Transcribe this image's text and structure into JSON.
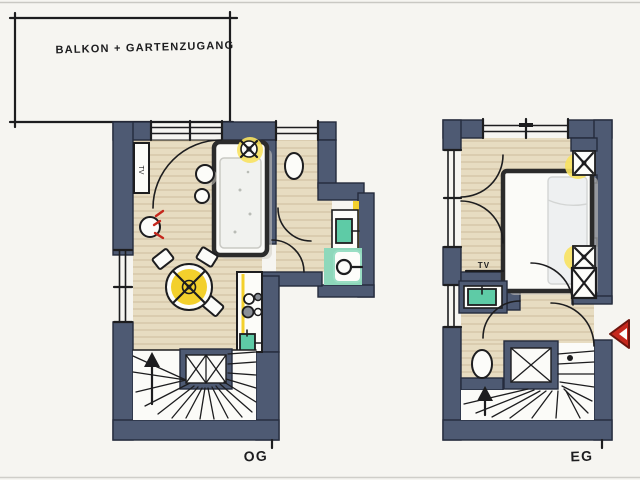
{
  "drawing": {
    "annotation_box": {
      "label": "BALKON + GARTENZUGANG"
    },
    "plans": [
      {
        "id": "og",
        "label": "OG",
        "tv_label": "TV"
      },
      {
        "id": "eg",
        "label": "EG",
        "tv_label": "TV"
      }
    ],
    "symbols": {
      "ceiling_lamp": "x-cross-lamp-icon",
      "pendant_lamp": "x-cross-lamp-icon",
      "shower_head": "circle-with-arm-icon",
      "stair_direction": "up-arrow-icon",
      "entrance": "red-triangle-arrow-icon"
    },
    "colors": {
      "paper": "#f6f5f1",
      "ink": "#1d1d1f",
      "wall": "#4e5a73",
      "wall_outline": "#252b3d",
      "floor": "#e7dcc1",
      "floor_grain": "#ccbd9d",
      "accent_yellow": "#f3d02c",
      "accent_glow": "#f8e261",
      "accent_teal": "#8ed8bb",
      "accent_green": "#5ecba6",
      "accent_red": "#c5271c"
    }
  }
}
